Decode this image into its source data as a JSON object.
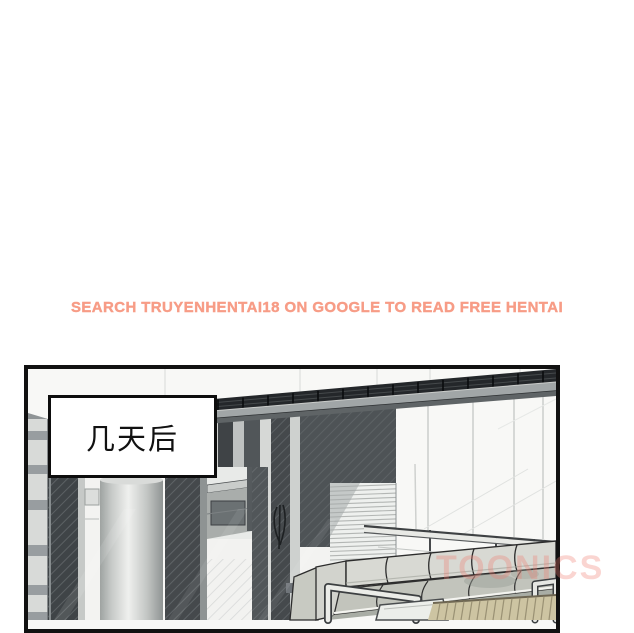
{
  "ad_banner": {
    "text": "SEARCH TRUYENHENTAI18 ON GOOGLE TO READ FREE HENTAI",
    "color": "#f79c86"
  },
  "comic_panel": {
    "caption_text": "几天后",
    "border_color": "#111111",
    "scene_elements": [
      "pergola-beam",
      "ceiling",
      "striped-columns",
      "cylinder-column",
      "sideboard-counter",
      "window-blinds",
      "glass-wall",
      "balcony-railing",
      "sectional-sofa",
      "wood-slat-table",
      "side-table"
    ]
  },
  "watermark": {
    "text": "TOONICS",
    "color": "#ef7d70"
  }
}
